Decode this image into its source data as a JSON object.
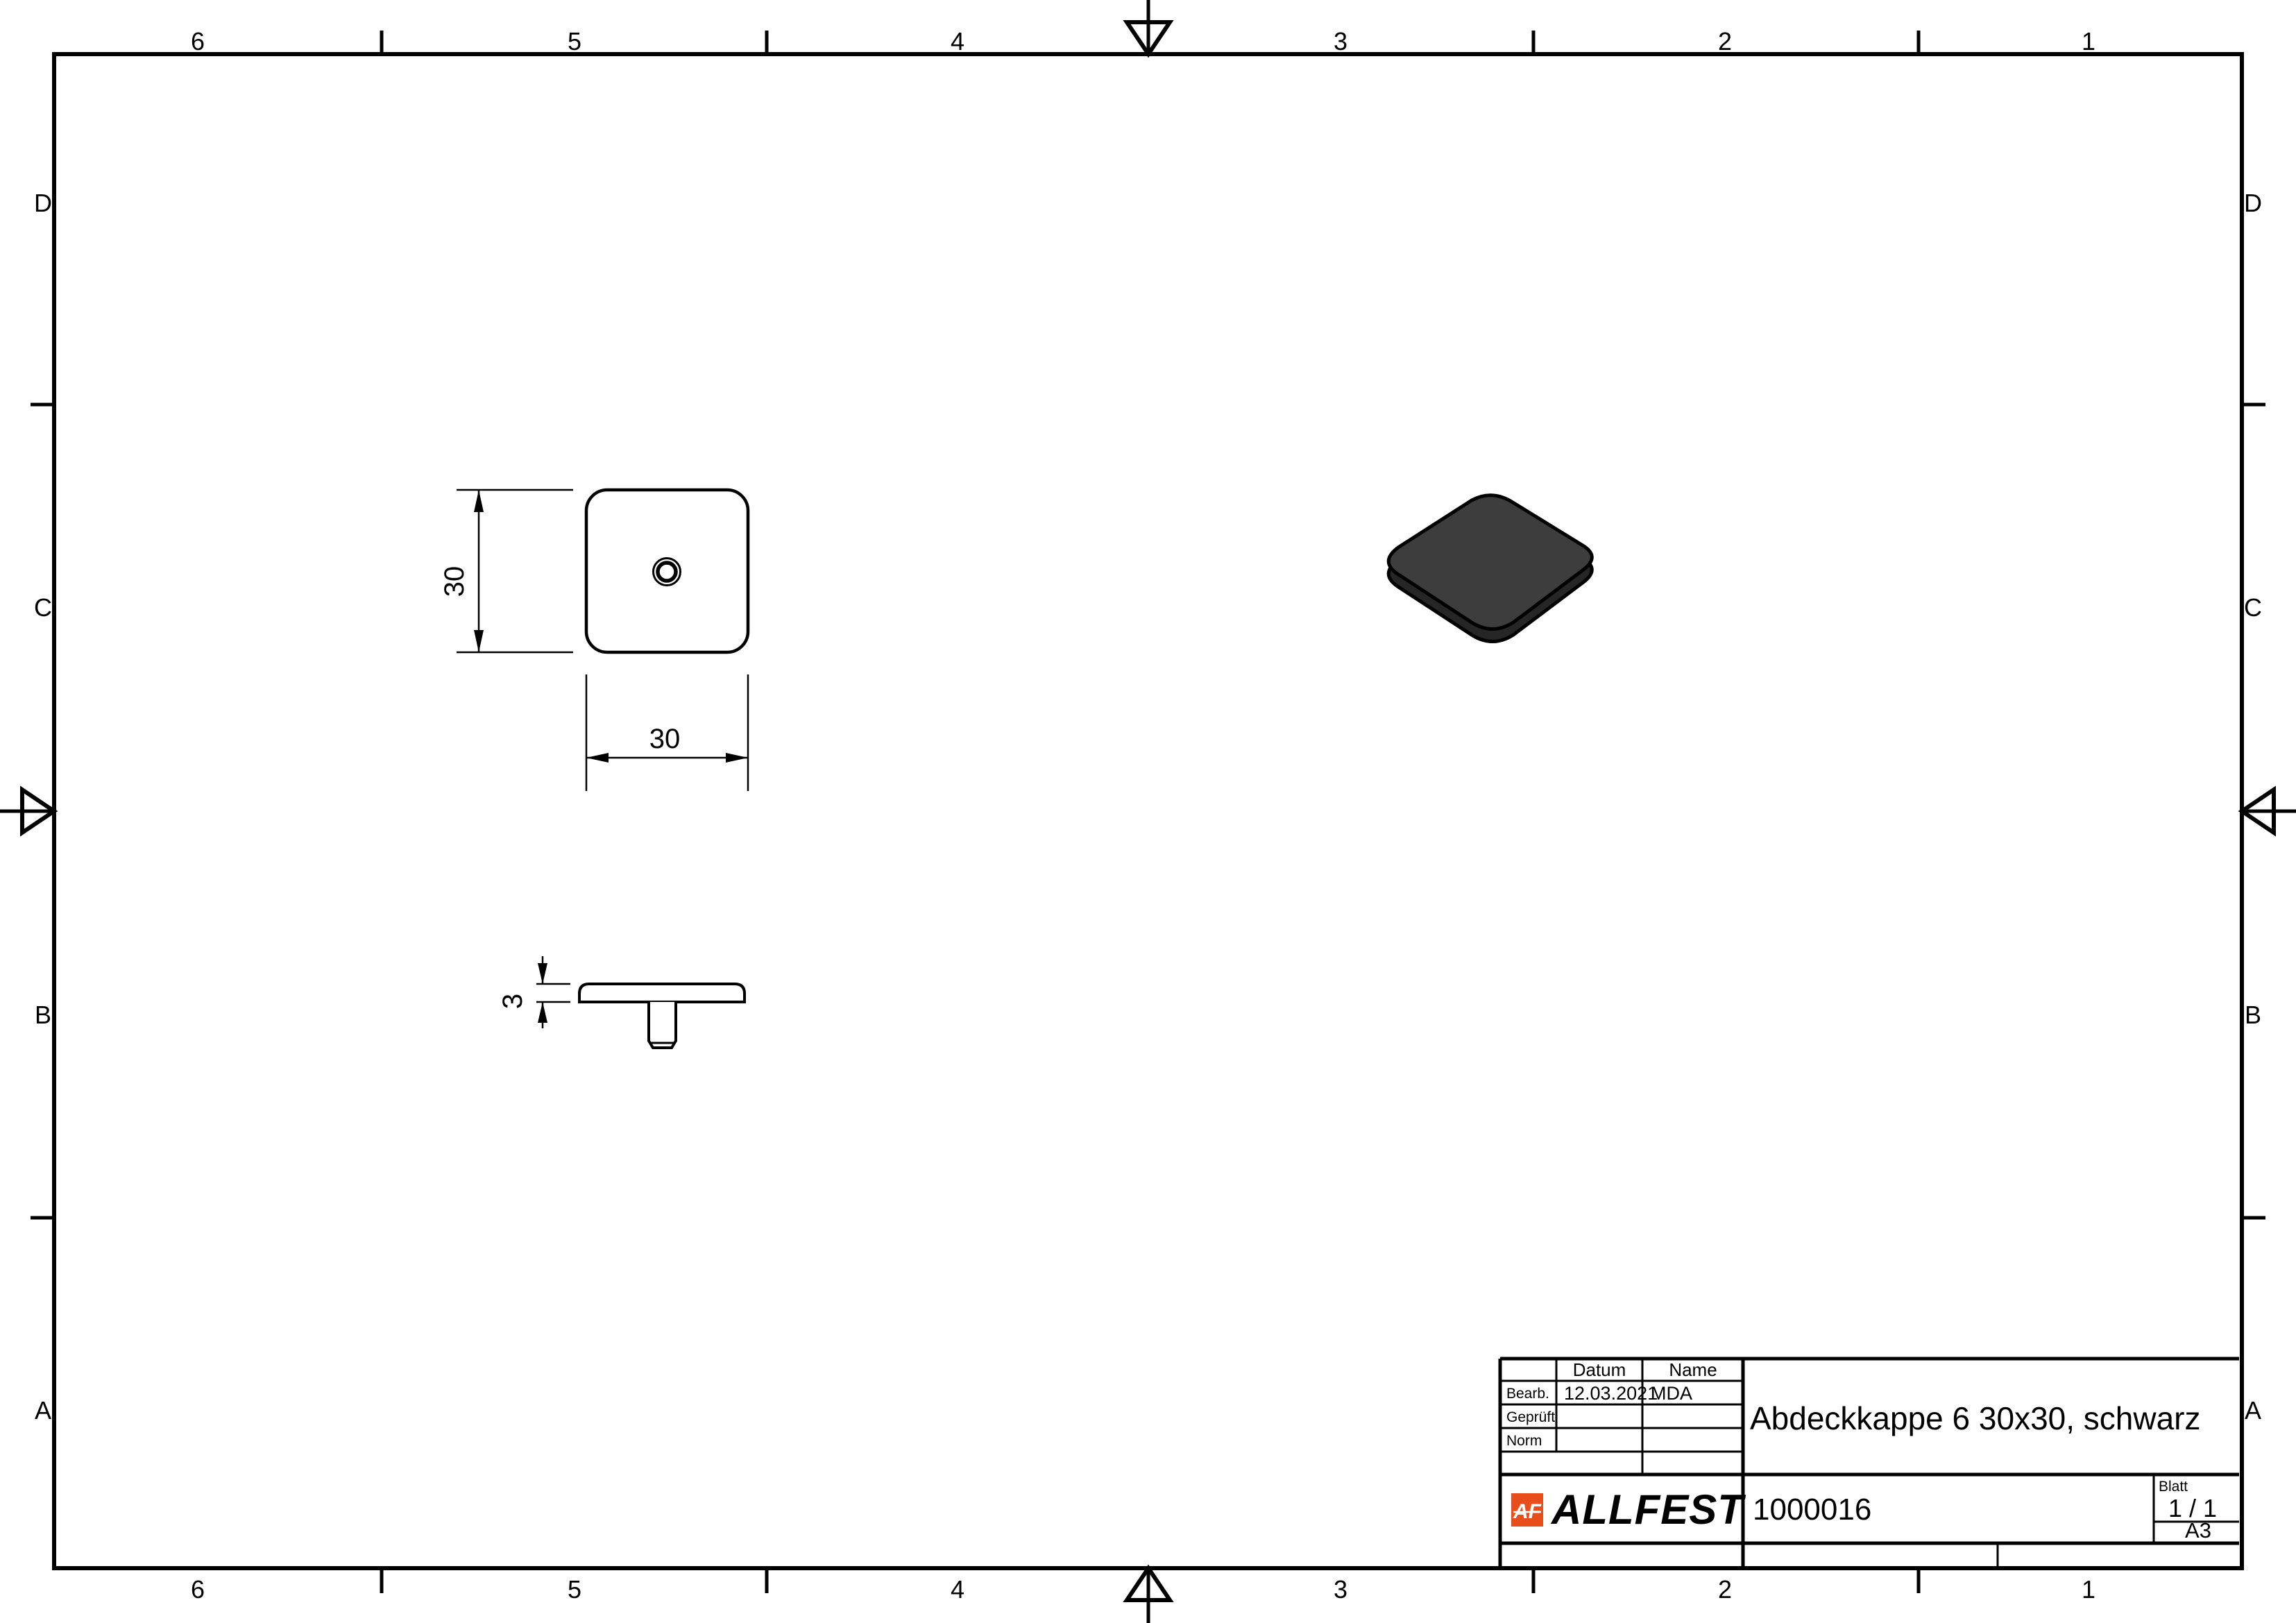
{
  "sheet": {
    "zone_columns": [
      "6",
      "5",
      "4",
      "3",
      "2",
      "1"
    ],
    "zone_rows": [
      "D",
      "C",
      "B",
      "A"
    ]
  },
  "title_block": {
    "col_headers": {
      "datum": "Datum",
      "name": "Name"
    },
    "rows": [
      {
        "label": "Bearb.",
        "datum": "12.03.2021",
        "name": "MDA"
      },
      {
        "label": "Geprüft",
        "datum": "",
        "name": ""
      },
      {
        "label": "Norm",
        "datum": "",
        "name": ""
      }
    ],
    "title": "Abdeckkappe 6 30x30, schwarz",
    "part_number": "1000016",
    "blatt_label": "Blatt",
    "sheet_of": "1 / 1",
    "format": "A3",
    "logo": {
      "brand": "ALLFEST",
      "monogram": "AF",
      "accent_color": "#e84e1b",
      "text_color": "#38383d"
    }
  },
  "views": {
    "top": {
      "dim_width": "30",
      "dim_height": "30"
    },
    "side": {
      "dim_thickness": "3"
    },
    "iso": {
      "part_color": "#3d3d3d",
      "part_shadow_color": "#262626"
    }
  }
}
